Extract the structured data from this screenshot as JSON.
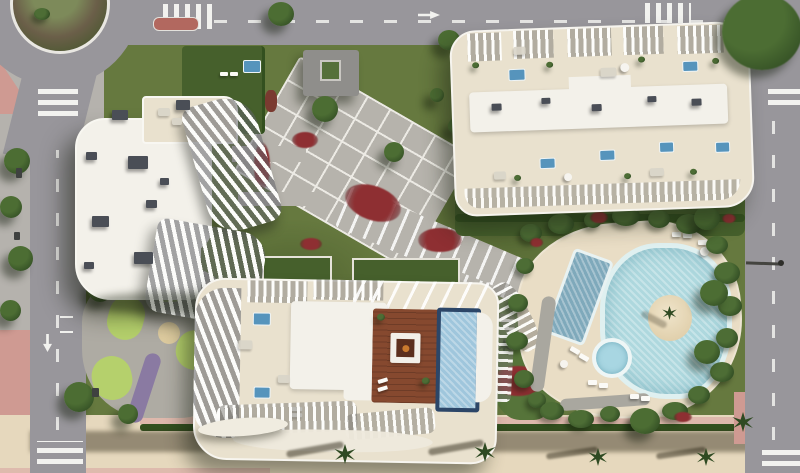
{
  "meta": {
    "title": "Top-down aerial 3D architectural render of a seafront residential resort block with three white apartment buildings, landscaped gardens, a lagoon pool and a beach promenade",
    "view": "top-down aerial",
    "setting": "coastal city block bounded by streets on the left, top and right, and a sandy promenade at the bottom"
  },
  "palette": {
    "road": "#98969b",
    "marking": "#f2f2ef",
    "walkGray": "#b5b2ad",
    "sidewalkPink": "#cf9a92",
    "sidewalkPinkLight": "#dcb3a9",
    "benchRed": "#b23b33",
    "sand": "#e6d8bd",
    "sandShadow": "rgba(52,44,26,0.45)",
    "grass": "#66793f",
    "grassDark": "#46602c",
    "hedge": "#33501f",
    "lawnLight": "#b5d06c",
    "plaza": "#b6b3ac",
    "plazaLine": "#eceae4",
    "pathGray": "#a9a79f",
    "cream": "#e9e1ce",
    "white": "#f3f1ea",
    "roofBox": "#4a4e56",
    "poolSmall": "#5694bc",
    "poolMain": "#aed8de",
    "poolLap": "#7fa9bb",
    "poolSpa": "#a8d6e2",
    "poolRoof": "#9fc6dc",
    "poolRoofEdge": "#2c4668",
    "deck": "#86492f",
    "tree": "#4c6d33",
    "treeDark": "#2f4a22",
    "bush": "#4d6d35",
    "redFlower": "#8e2f32",
    "purplePath": "#8a7aa2",
    "islandGreen": "#7d8a5a",
    "islandSoil": "#6b5f49"
  },
  "scene": {
    "roads": {
      "left_street": "two-lane street with zebra crossings, lane arrow and parking bays",
      "top_avenue": "avenue with dashed center line, right-turn arrow and two zebra crossings",
      "right_avenue": "avenue with dashed lanes, two zebra crossings and a street lamp",
      "roundabout": "landscaped roundabout at the top-left corner"
    },
    "buildings": [
      {
        "id": "northwest-tower",
        "features": "white roof with skylight boxes, cream upper terrace, wavy white balcony fins on the east and south facades"
      },
      {
        "id": "northeast-block",
        "features": "cream roof terraces with slatted pergolas, six plunge pools, umbrellas and a white central roof spine; garden with three ground-floor pools below"
      },
      {
        "id": "south-beachfront-block",
        "features": "roof terraces with pergolas, two plunge pools, large timber deck with fire-pit pavilion and a navy-edged infinity pool facing the promenade"
      }
    ],
    "amenities": [
      "free-form lagoon pool with central sand island and planting",
      "diagonal lap pool",
      "round spa pool",
      "sun loungers and parasols on a curved beige deck",
      "central paved plaza with white grid joints",
      "long striped walkway crossing the gardens",
      "putting-green style lawns with purple garden path",
      "gray garden pavilion with inner courtyard",
      "palm-lined sandy beach promenade with hedge"
    ],
    "vegetation": "perimeter hedges, palm trees, round canopy trees, burgundy flower beds and lawn panels"
  }
}
